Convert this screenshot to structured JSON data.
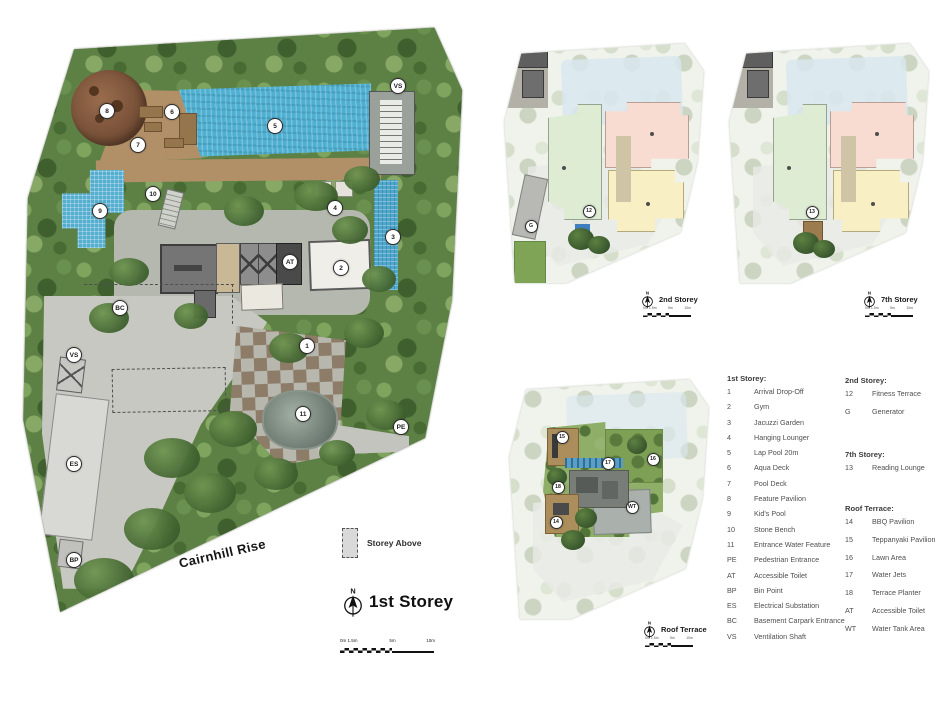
{
  "main_plan": {
    "title": "1st Storey",
    "north_label": "N",
    "street_label": "Cairnhill Rise",
    "storey_above_label": "Storey Above",
    "scale_labels": [
      "0m 1.5m",
      "5m",
      "10m"
    ],
    "markers": [
      {
        "label": "8",
        "x": 92,
        "y": 92
      },
      {
        "label": "6",
        "x": 157,
        "y": 93
      },
      {
        "label": "5",
        "x": 260,
        "y": 107
      },
      {
        "label": "7",
        "x": 123,
        "y": 126
      },
      {
        "label": "VS",
        "x": 383,
        "y": 67
      },
      {
        "label": "10",
        "x": 138,
        "y": 175
      },
      {
        "label": "9",
        "x": 85,
        "y": 192
      },
      {
        "label": "4",
        "x": 320,
        "y": 189
      },
      {
        "label": "3",
        "x": 378,
        "y": 218
      },
      {
        "label": "2",
        "x": 326,
        "y": 249
      },
      {
        "label": "AT",
        "x": 275,
        "y": 243
      },
      {
        "label": "BC",
        "x": 105,
        "y": 289
      },
      {
        "label": "VS",
        "x": 59,
        "y": 336
      },
      {
        "label": "ES",
        "x": 59,
        "y": 445
      },
      {
        "label": "BP",
        "x": 59,
        "y": 541
      },
      {
        "label": "1",
        "x": 292,
        "y": 327
      },
      {
        "label": "11",
        "x": 288,
        "y": 395
      },
      {
        "label": "PE",
        "x": 386,
        "y": 408
      }
    ]
  },
  "sub_plans": [
    {
      "title": "2nd Storey",
      "markers": [
        {
          "label": "12",
          "x": 90,
          "y": 174
        },
        {
          "label": "G",
          "x": 32,
          "y": 189
        }
      ]
    },
    {
      "title": "7th Storey",
      "markers": [
        {
          "label": "13",
          "x": 88,
          "y": 175
        }
      ]
    },
    {
      "title": "Roof Terrace",
      "markers": [
        {
          "label": "15",
          "x": 58,
          "y": 64
        },
        {
          "label": "17",
          "x": 104,
          "y": 90
        },
        {
          "label": "16",
          "x": 149,
          "y": 86
        },
        {
          "label": "18",
          "x": 54,
          "y": 114
        },
        {
          "label": "14",
          "x": 52,
          "y": 149
        },
        {
          "label": "WT",
          "x": 128,
          "y": 134
        }
      ]
    }
  ],
  "legend": {
    "col1": {
      "heading": "1st Storey:",
      "items": [
        {
          "code": "1",
          "label": "Arrival Drop-Off"
        },
        {
          "code": "2",
          "label": "Gym"
        },
        {
          "code": "3",
          "label": "Jacuzzi Garden"
        },
        {
          "code": "4",
          "label": "Hanging Lounger"
        },
        {
          "code": "5",
          "label": "Lap Pool 20m"
        },
        {
          "code": "6",
          "label": "Aqua Deck"
        },
        {
          "code": "7",
          "label": "Pool Deck"
        },
        {
          "code": "8",
          "label": "Feature Pavilion"
        },
        {
          "code": "9",
          "label": "Kid's Pool"
        },
        {
          "code": "10",
          "label": "Stone Bench"
        },
        {
          "code": "11",
          "label": "Entrance Water Feature"
        },
        {
          "code": "PE",
          "label": "Pedestrian Entrance"
        },
        {
          "code": "AT",
          "label": "Accessible Toilet"
        },
        {
          "code": "BP",
          "label": "Bin Point"
        },
        {
          "code": "ES",
          "label": "Electrical Substation"
        },
        {
          "code": "BC",
          "label": "Basement Carpark Entrance"
        },
        {
          "code": "VS",
          "label": "Ventilation Shaft"
        }
      ]
    },
    "col2_sections": [
      {
        "heading": "2nd Storey:",
        "items": [
          {
            "code": "12",
            "label": "Fitness Terrace"
          },
          {
            "code": "G",
            "label": "Generator"
          }
        ]
      },
      {
        "heading": "7th Storey:",
        "items": [
          {
            "code": "13",
            "label": "Reading Lounge"
          }
        ]
      },
      {
        "heading": "Roof Terrace:",
        "items": [
          {
            "code": "14",
            "label": "BBQ Pavilion"
          },
          {
            "code": "15",
            "label": "Teppanyaki Pavilion"
          },
          {
            "code": "16",
            "label": "Lawn Area"
          },
          {
            "code": "17",
            "label": "Water Jets"
          },
          {
            "code": "18",
            "label": "Terrace Planter"
          },
          {
            "code": "AT",
            "label": "Accessible Toilet"
          },
          {
            "code": "WT",
            "label": "Water Tank Area"
          }
        ]
      }
    ]
  },
  "colors": {
    "pool_blue": "#4fb0d2",
    "deck_brown": "#b29067",
    "foliage_green": "#5d8145",
    "unit_green": "#ddecd2",
    "unit_pink": "#f8dcd1",
    "unit_yellow": "#f8efc4",
    "fitness_blue": "#3f7fc0",
    "lawn_green": "#7fa455",
    "driveway_gray": "#c6c8c1"
  }
}
